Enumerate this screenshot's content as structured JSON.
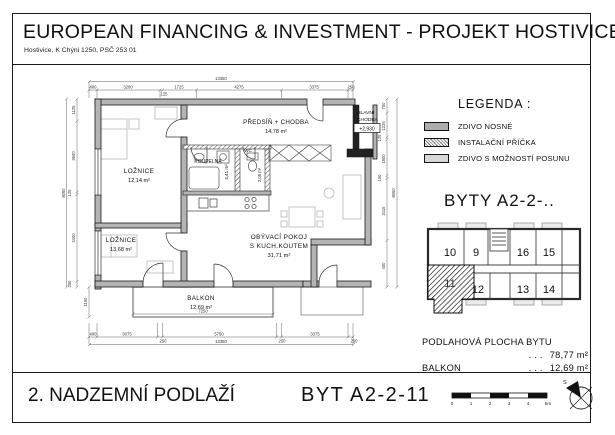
{
  "header": {
    "title": "EUROPEAN FINANCING & INVESTMENT - PROJEKT HOSTIVICE JIH s.r.o.",
    "address": "Hostivice, K Chýni 1250, PSČ 253 01"
  },
  "footer": {
    "floor": "2. NADZEMNÍ PODLAŽÍ",
    "apartment": "BYT  A2-2-11",
    "scale_ticks": [
      "0",
      "1",
      "2",
      "3",
      "4",
      "5m"
    ],
    "north_label": "S"
  },
  "legend": {
    "title": "LEGENDA :",
    "items": [
      {
        "label": "ZDIVO NOSNÉ"
      },
      {
        "label": "INSTALAČNÍ PŘÍČKA"
      },
      {
        "label": "ZDIVO S MOŽNOSTÍ POSUNU"
      }
    ]
  },
  "key_plan": {
    "title": "BYTY  A2-2-..",
    "units_top": [
      "10",
      "9",
      "16",
      "15"
    ],
    "units_bottom": [
      "12",
      "13",
      "14"
    ],
    "highlighted_unit": "11"
  },
  "areas": {
    "floor_area_label": "PODLAHOVÁ PLOCHA BYTU",
    "dots": ". . .",
    "floor_area_value": "78,77 m²",
    "balcony_label": "BALKON",
    "balcony_value": "12,69 m²"
  },
  "floor_plan": {
    "rooms": {
      "loznice1": {
        "name": "LOŽNICE",
        "area": "12,14 m²"
      },
      "loznice2": {
        "name": "LOŽNICE",
        "area": "13,68 m²"
      },
      "predsin": {
        "name": "PŘEDSÍŇ + CHODBA",
        "area": "14,78 m²"
      },
      "koupelna": {
        "name": "KOUPELNA",
        "area": "4,41 m²"
      },
      "wc": {
        "name": "WC",
        "area": "2,05 m²"
      },
      "obyvaci": {
        "name": "OBÝVACÍ POKOJ",
        "name2": "S KUCH.KOUTEM",
        "area": "31,71 m²"
      },
      "balkon": {
        "name": "BALKON",
        "area": "12,69 m²"
      }
    },
    "corridor": {
      "label1": "HLAVNÍ",
      "label2": "CHODBA",
      "elevation": "+2,930"
    },
    "dims_top": [
      "400",
      "3200",
      "125",
      "1725",
      "4275",
      "3375",
      "250"
    ],
    "dims_top_total": "13350",
    "dims_bottom": [
      "400",
      "3075",
      "250",
      "5750",
      "250",
      "3375",
      "250"
    ],
    "dims_bottom_total": "13350",
    "dims_left": [
      "1125",
      "3600",
      "125",
      "4400",
      "250"
    ],
    "dims_left_total": "8060",
    "dim_balcony_left": "1100",
    "dims_right": [
      "700",
      "1225",
      "125",
      "1800",
      "150",
      "3115",
      "400"
    ],
    "dims_right_total": "8060",
    "dim_balcony": "7250"
  },
  "colors": {
    "wall_fill": "#b4b4b4",
    "line": "#1a1a1a",
    "furniture": "#b8b8b8"
  }
}
